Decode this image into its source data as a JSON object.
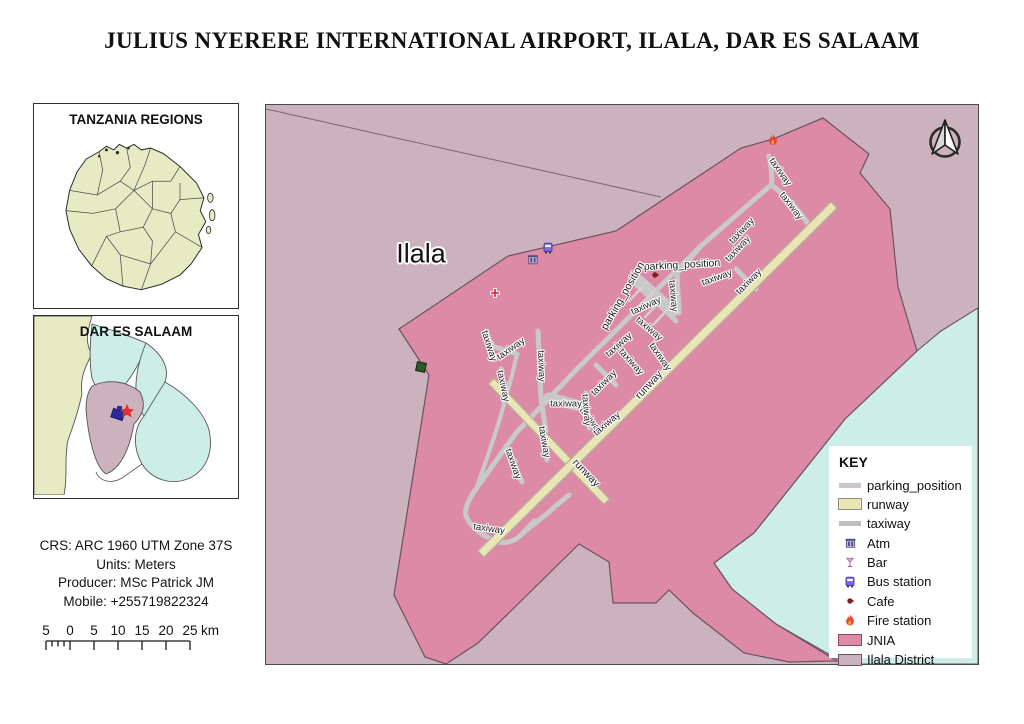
{
  "page": {
    "title": "JULIUS NYERERE INTERNATIONAL AIRPORT, ILALA, DAR ES SALAAM"
  },
  "insets": {
    "tanzania_title": "TANZANIA REGIONS",
    "dar_title": "DAR ES SALAAM"
  },
  "info": {
    "lines": [
      "CRS: ARC 1960 UTM Zone 37S",
      "Units: Meters",
      "Producer: MSc Patrick JM",
      "Mobile: +255719822324"
    ]
  },
  "scalebar": {
    "labels": [
      "5",
      "0",
      "5",
      "10",
      "15",
      "20",
      "25"
    ],
    "unit": "km"
  },
  "map": {
    "region_label": "Ilala",
    "colors": {
      "jnia": "#dd8aa6",
      "ilala_district": "#cbb2bd",
      "neighbor_district": "#cdeee6",
      "runway_fill": "#eae5b4",
      "runway_casing": "#b5b09a",
      "taxiway": "#c9c9c9",
      "parking_position": "#d8ccd4",
      "boundary": "#6b5260"
    },
    "labels": {
      "taxiway": {
        "text": "taxiway",
        "positions": [
          [
            514,
            67,
            55
          ],
          [
            525,
            101,
            52
          ],
          [
            476,
            126,
            -47
          ],
          [
            472,
            144,
            -47
          ],
          [
            451,
            173,
            -20
          ],
          [
            483,
            177,
            -45
          ],
          [
            407,
            191,
            85
          ],
          [
            380,
            201,
            -25
          ],
          [
            383,
            224,
            40
          ],
          [
            353,
            240,
            -42
          ],
          [
            365,
            257,
            48
          ],
          [
            394,
            252,
            55
          ],
          [
            338,
            278,
            -45
          ],
          [
            325,
            316,
            52
          ],
          [
            341,
            319,
            -40
          ],
          [
            223,
            241,
            72
          ],
          [
            245,
            244,
            -35
          ],
          [
            275,
            261,
            88
          ],
          [
            237,
            281,
            78
          ],
          [
            300,
            299,
            0
          ],
          [
            320,
            305,
            85
          ],
          [
            278,
            337,
            80
          ],
          [
            247,
            359,
            70
          ],
          [
            223,
            424,
            8
          ]
        ]
      },
      "runway": {
        "text": "runway",
        "positions": [
          [
            383,
            280,
            -47
          ],
          [
            320,
            368,
            46
          ]
        ]
      },
      "parking_position": {
        "text": "parking_position",
        "positions": [
          [
            416,
            160,
            -3
          ],
          [
            357,
            191,
            -60
          ]
        ]
      }
    },
    "pois": [
      {
        "icon": "fire",
        "x": 507,
        "y": 35
      },
      {
        "icon": "bus",
        "x": 282,
        "y": 143
      },
      {
        "icon": "atm",
        "x": 267,
        "y": 155
      },
      {
        "icon": "cross",
        "x": 229,
        "y": 188
      },
      {
        "icon": "cafe",
        "x": 389,
        "y": 170
      }
    ]
  },
  "key": {
    "title": "KEY",
    "items": [
      {
        "label": "parking_position",
        "type": "line",
        "color": "#cfc5cc"
      },
      {
        "label": "runway",
        "type": "rect",
        "color": "#eae5b4",
        "border": "#8f8f86"
      },
      {
        "label": "taxiway",
        "type": "line",
        "color": "#bfbfbf"
      },
      {
        "label": "Atm",
        "type": "icon",
        "icon": "atm"
      },
      {
        "label": "Bar",
        "type": "icon",
        "icon": "bar"
      },
      {
        "label": "Bus station",
        "type": "icon",
        "icon": "bus"
      },
      {
        "label": "Cafe",
        "type": "icon",
        "icon": "cafe"
      },
      {
        "label": "Fire station",
        "type": "icon",
        "icon": "fire"
      },
      {
        "label": "JNIA",
        "type": "rect",
        "color": "#dd8aa6",
        "border": "#8c4a62"
      },
      {
        "label": "Ilala District",
        "type": "rect",
        "color": "#cbb2bd",
        "border": "#6a5560"
      }
    ]
  }
}
